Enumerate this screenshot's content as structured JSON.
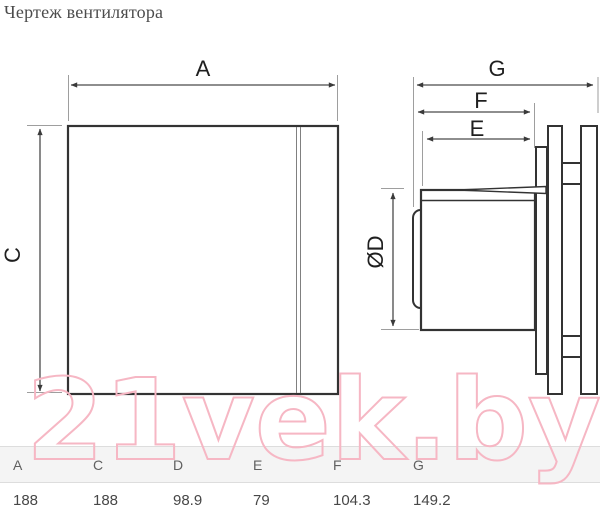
{
  "title": "Чертеж вентилятора",
  "watermark": {
    "text": "21vek.by",
    "stroke_color": "#f6b7c4"
  },
  "drawing": {
    "labels": {
      "a": "A",
      "c": "C",
      "d": "ØD",
      "e": "E",
      "f": "F",
      "g": "G"
    },
    "line_color": "#333333",
    "dim_color": "#4a4a4a",
    "ext_color": "#9e9e9e"
  },
  "dimensions_mm": {
    "A": 188,
    "C": 188,
    "D": 98.9,
    "E": 79,
    "F": 104.3,
    "G": 149.2
  },
  "table": {
    "headers": [
      "A",
      "C",
      "D",
      "E",
      "F",
      "G"
    ],
    "values": [
      "188",
      "188",
      "98.9",
      "79",
      "104.3",
      "149.2"
    ]
  }
}
